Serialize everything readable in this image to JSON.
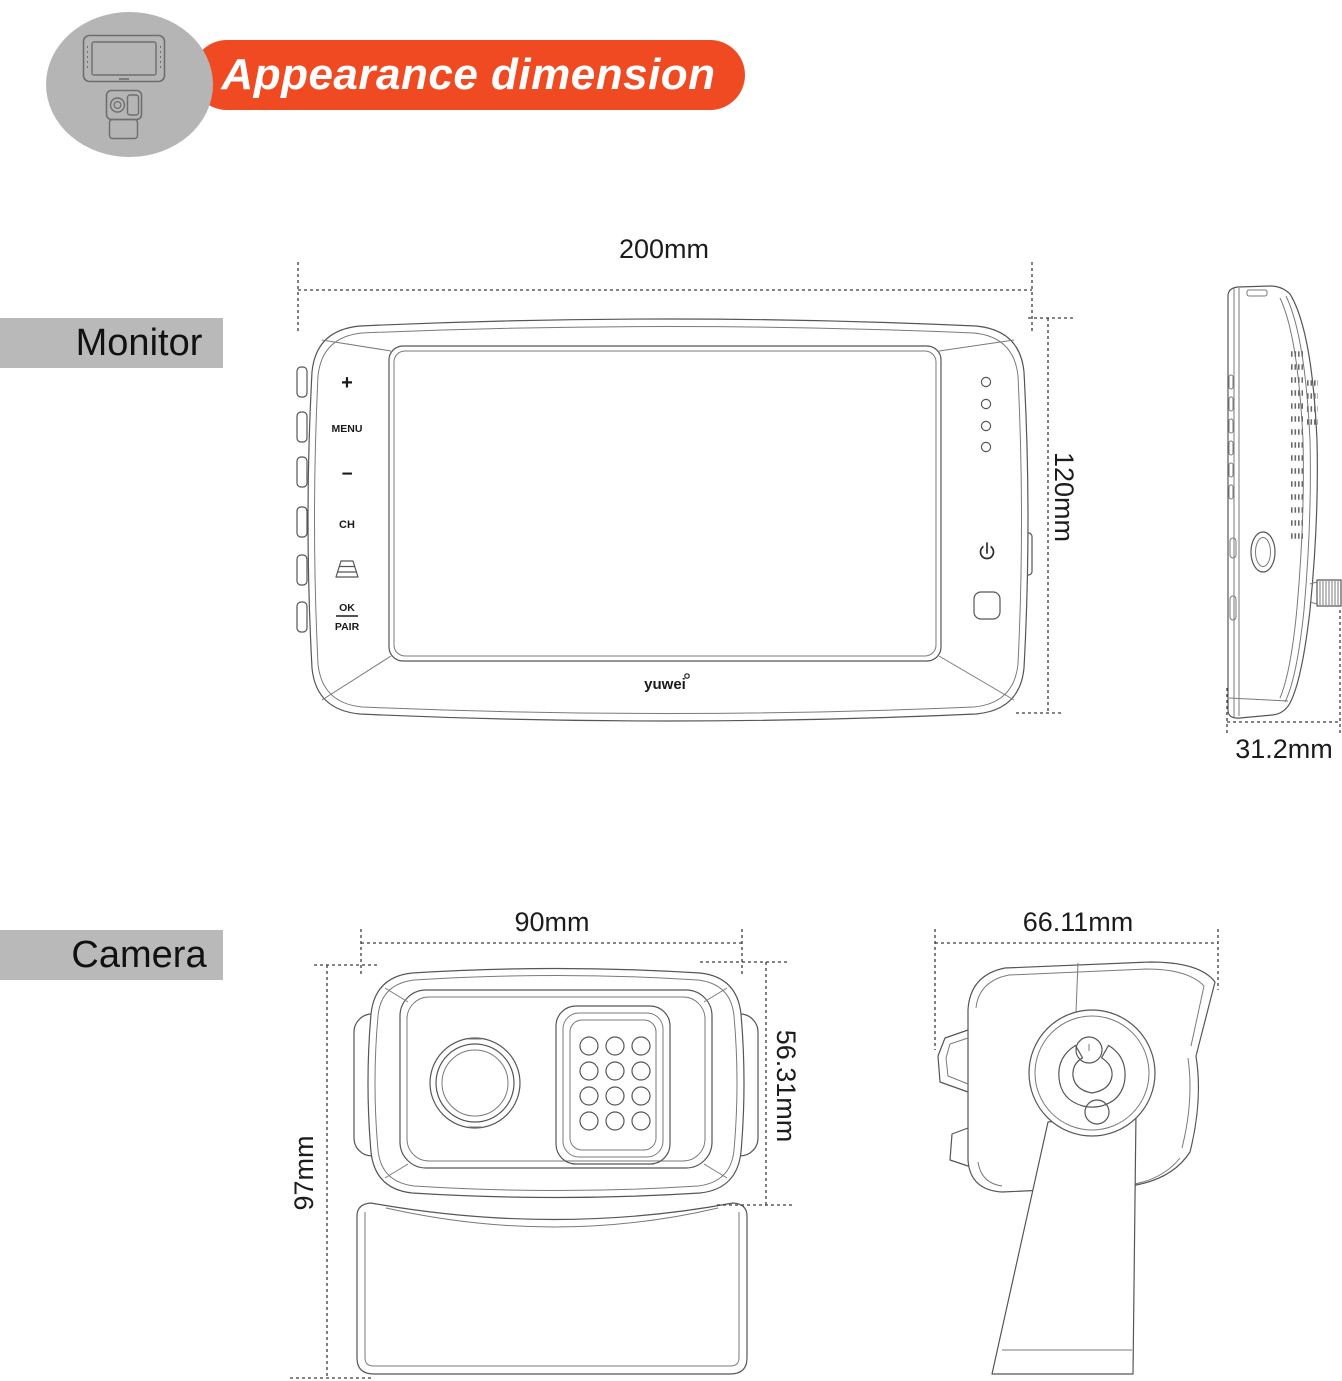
{
  "header": {
    "title": "Appearance dimension"
  },
  "colors": {
    "accent_orange": "#f04a23",
    "section_label_bg": "#b9b9b9",
    "drawing_line": "#565656"
  },
  "monitor": {
    "section_label": "Monitor",
    "dims": {
      "width": "200mm",
      "height": "120mm",
      "depth": "31.2mm"
    },
    "controls": {
      "plus": "+",
      "menu": "MENU",
      "minus": "−",
      "channel": "CH",
      "ok": "OK",
      "pair": "PAIR"
    },
    "brand": "yuwei"
  },
  "camera": {
    "section_label": "Camera",
    "dims": {
      "width": "90mm",
      "lens_height": "56.31mm",
      "height": "97mm",
      "depth": "66.11mm"
    }
  }
}
